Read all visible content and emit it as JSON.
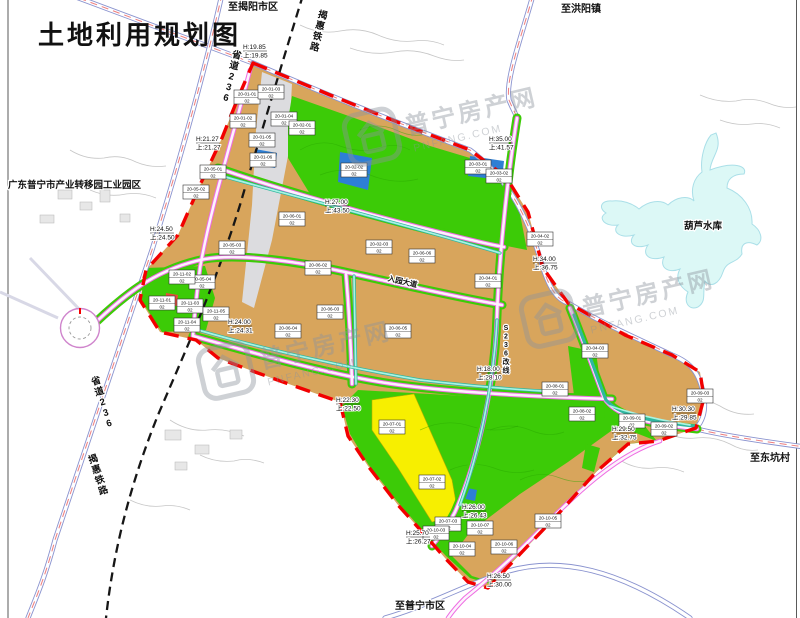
{
  "page": {
    "title": "土地利用规划图"
  },
  "colors": {
    "construction_land": "#d8a55c",
    "green_space": "#3ccb07",
    "yellow_land": "#f7ef00",
    "reservoir_water": "#dcf8f6",
    "blue_land": "#2e7fd4",
    "road_pink": "#ee6ce2",
    "canal": "#a9f3e3",
    "boundary_red": "#f20000",
    "highway_outline": "#8a93cf",
    "railway_black": "#161616"
  },
  "region_labels": [
    {
      "id": "to-jieyang",
      "text": "至揭阳市区",
      "x": 253,
      "y": 10,
      "rot": 0,
      "size": 10,
      "vertical": false,
      "anchor": "middle"
    },
    {
      "id": "to-hongyang",
      "text": "至洪阳镇",
      "x": 581,
      "y": 12,
      "rot": 0,
      "size": 10,
      "vertical": false,
      "anchor": "middle"
    },
    {
      "id": "to-dongkeng",
      "text": "至东坑村",
      "x": 770,
      "y": 461,
      "rot": 0,
      "size": 10,
      "vertical": false,
      "anchor": "middle"
    },
    {
      "id": "to-puning",
      "text": "至普宁市区",
      "x": 420,
      "y": 609,
      "rot": 0,
      "size": 10,
      "vertical": false,
      "anchor": "middle"
    },
    {
      "id": "industrial-park",
      "text": "广东普宁市产业转移园工业园区",
      "x": 8,
      "y": 188,
      "rot": 0,
      "size": 9.5,
      "vertical": false,
      "anchor": "start"
    },
    {
      "id": "hulu-reservoir",
      "text": "葫芦水库",
      "x": 703,
      "y": 229,
      "rot": 0,
      "size": 9.5,
      "vertical": false,
      "anchor": "middle"
    },
    {
      "id": "railway-top",
      "text": "揭惠铁路",
      "x": 322,
      "y": 18,
      "rot": 14,
      "size": 9.5,
      "vertical": true,
      "anchor": "middle"
    },
    {
      "id": "railway-bottom",
      "text": "揭惠铁路",
      "x": 94,
      "y": 462,
      "rot": -18,
      "size": 9.5,
      "vertical": true,
      "anchor": "middle"
    },
    {
      "id": "s236-top",
      "text": "省道236",
      "x": 236,
      "y": 58,
      "rot": 14,
      "size": 9.5,
      "vertical": true,
      "anchor": "middle"
    },
    {
      "id": "s236-bottom",
      "text": "省道236",
      "x": 97,
      "y": 384,
      "rot": -17,
      "size": 9.5,
      "vertical": true,
      "anchor": "middle"
    },
    {
      "id": "s236-realign",
      "text": "S236改线",
      "x": 506,
      "y": 330,
      "rot": 0,
      "size": 7,
      "vertical": true,
      "anchor": "middle"
    },
    {
      "id": "entry-avenue",
      "text": "入园大道",
      "x": 402,
      "y": 284,
      "rot": 13,
      "size": 7.5,
      "vertical": false,
      "anchor": "middle"
    }
  ],
  "elevation_labels": [
    {
      "l1": "H:19.85",
      "l2": "上:19.85",
      "x": 243,
      "y": 49
    },
    {
      "l1": "H:21.27",
      "l2": "上:21.27",
      "x": 196,
      "y": 141
    },
    {
      "l1": "H:24.50",
      "l2": "上:24.50",
      "x": 150,
      "y": 231
    },
    {
      "l1": "H:35.00",
      "l2": "上:41.57",
      "x": 489,
      "y": 141
    },
    {
      "l1": "H:34.00",
      "l2": "上:36.75",
      "x": 533,
      "y": 261
    },
    {
      "l1": "H:27.00",
      "l2": "上:43.50",
      "x": 325,
      "y": 204
    },
    {
      "l1": "H:24.00",
      "l2": "上:24.31",
      "x": 228,
      "y": 324
    },
    {
      "l1": "H:22.30",
      "l2": "上:22.50",
      "x": 336,
      "y": 402
    },
    {
      "l1": "H:18.00",
      "l2": "上:28.10",
      "x": 477,
      "y": 371
    },
    {
      "l1": "H:29.50",
      "l2": "上:32.75",
      "x": 612,
      "y": 431
    },
    {
      "l1": "H:30.30",
      "l2": "上:29.85",
      "x": 672,
      "y": 411
    },
    {
      "l1": "H:25.70",
      "l2": "上:26.27",
      "x": 406,
      "y": 535
    },
    {
      "l1": "H:26.00",
      "l2": "上:26.43",
      "x": 462,
      "y": 509
    },
    {
      "l1": "H:26.50",
      "l2": "上:30.00",
      "x": 487,
      "y": 578
    }
  ],
  "parcels": [
    {
      "code": "20-01-01",
      "cls": "02",
      "x": 247,
      "y": 97
    },
    {
      "code": "20-01-02",
      "cls": "02",
      "x": 243,
      "y": 121
    },
    {
      "code": "20-01-03",
      "cls": "02",
      "x": 271,
      "y": 92
    },
    {
      "code": "20-01-04",
      "cls": "02",
      "x": 284,
      "y": 119
    },
    {
      "code": "20-01-05",
      "cls": "02",
      "x": 262,
      "y": 140
    },
    {
      "code": "20-01-06",
      "cls": "02",
      "x": 263,
      "y": 160
    },
    {
      "code": "20-02-01",
      "cls": "02",
      "x": 302,
      "y": 128
    },
    {
      "code": "20-02-02",
      "cls": "02",
      "x": 354,
      "y": 170
    },
    {
      "code": "20-02-03",
      "cls": "02",
      "x": 379,
      "y": 247
    },
    {
      "code": "20-03-01",
      "cls": "02",
      "x": 478,
      "y": 167
    },
    {
      "code": "20-03-02",
      "cls": "02",
      "x": 499,
      "y": 176
    },
    {
      "code": "20-04-01",
      "cls": "02",
      "x": 488,
      "y": 281
    },
    {
      "code": "20-04-02",
      "cls": "02",
      "x": 540,
      "y": 239
    },
    {
      "code": "20-04-03",
      "cls": "02",
      "x": 595,
      "y": 351
    },
    {
      "code": "20-05-01",
      "cls": "02",
      "x": 213,
      "y": 172
    },
    {
      "code": "20-05-02",
      "cls": "02",
      "x": 196,
      "y": 192
    },
    {
      "code": "20-05-03",
      "cls": "02",
      "x": 232,
      "y": 248
    },
    {
      "code": "20-05-04",
      "cls": "02",
      "x": 202,
      "y": 282
    },
    {
      "code": "20-06-01",
      "cls": "02",
      "x": 292,
      "y": 219
    },
    {
      "code": "20-06-02",
      "cls": "02",
      "x": 318,
      "y": 268
    },
    {
      "code": "20-06-03",
      "cls": "02",
      "x": 330,
      "y": 312
    },
    {
      "code": "20-06-04",
      "cls": "02",
      "x": 288,
      "y": 331
    },
    {
      "code": "20-06-05",
      "cls": "02",
      "x": 398,
      "y": 331
    },
    {
      "code": "20-06-06",
      "cls": "02",
      "x": 422,
      "y": 256
    },
    {
      "code": "20-07-01",
      "cls": "02",
      "x": 392,
      "y": 427
    },
    {
      "code": "20-07-02",
      "cls": "02",
      "x": 432,
      "y": 482
    },
    {
      "code": "20-07-03",
      "cls": "02",
      "x": 448,
      "y": 524
    },
    {
      "code": "20-08-01",
      "cls": "02",
      "x": 555,
      "y": 389
    },
    {
      "code": "20-08-02",
      "cls": "02",
      "x": 582,
      "y": 414
    },
    {
      "code": "20-09-01",
      "cls": "02",
      "x": 632,
      "y": 421
    },
    {
      "code": "20-09-02",
      "cls": "02",
      "x": 664,
      "y": 429
    },
    {
      "code": "20-09-03",
      "cls": "02",
      "x": 700,
      "y": 396
    },
    {
      "code": "20-10-03",
      "cls": "02",
      "x": 436,
      "y": 533
    },
    {
      "code": "20-10-04",
      "cls": "02",
      "x": 462,
      "y": 549
    },
    {
      "code": "20-10-05",
      "cls": "02",
      "x": 548,
      "y": 521
    },
    {
      "code": "20-10-06",
      "cls": "02",
      "x": 504,
      "y": 547
    },
    {
      "code": "20-10-07",
      "cls": "02",
      "x": 480,
      "y": 528
    },
    {
      "code": "20-11-01",
      "cls": "02",
      "x": 162,
      "y": 303
    },
    {
      "code": "20-11-02",
      "cls": "02",
      "x": 182,
      "y": 277
    },
    {
      "code": "20-11-03",
      "cls": "02",
      "x": 190,
      "y": 306
    },
    {
      "code": "20-11-04",
      "cls": "02",
      "x": 187,
      "y": 325
    },
    {
      "code": "20-11-05",
      "cls": "02",
      "x": 216,
      "y": 314
    }
  ],
  "watermark": {
    "name": "普宁房产网",
    "url": "PNFANG.COM",
    "positions": [
      {
        "x": 342,
        "y": 118,
        "rot": -13
      },
      {
        "x": 196,
        "y": 352,
        "rot": -13
      },
      {
        "x": 519,
        "y": 300,
        "rot": -13
      }
    ]
  }
}
